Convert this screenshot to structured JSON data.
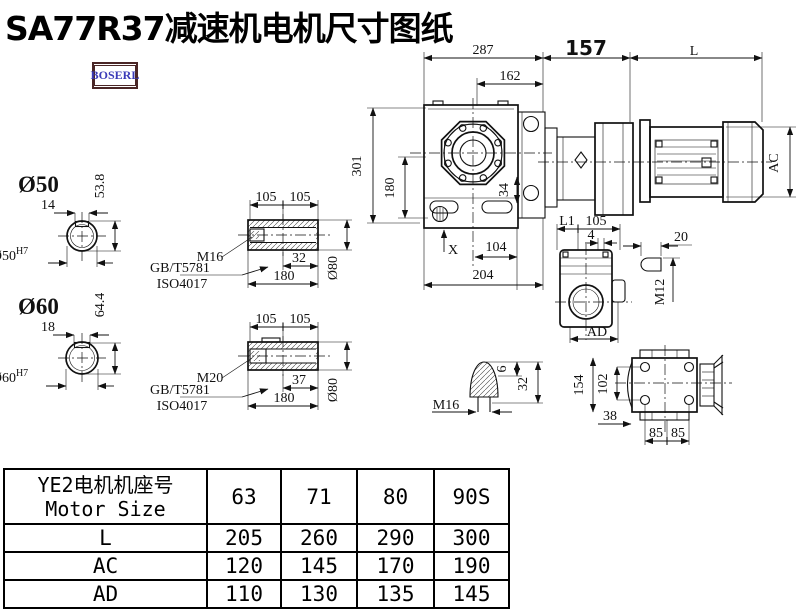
{
  "title": "SA77R37减速机电机尺寸图纸",
  "logo": {
    "text": "BOSERL"
  },
  "colors": {
    "line": "#111111",
    "logo_border": "#4a2626",
    "logo_text": "#3b3bb8",
    "background": "#ffffff"
  },
  "drawing": {
    "top": {
      "d287": "287",
      "d162": "162",
      "d157": "157",
      "dL": "L"
    },
    "front": {
      "d301": "301",
      "d180": "180",
      "d34": "34",
      "dX": "X",
      "d104": "104",
      "d204": "204"
    },
    "motor": {
      "dAC": "AC"
    },
    "side": {
      "dL1": "L1",
      "d105": "105",
      "d4": "4",
      "dAD": "AD"
    },
    "plug": {
      "d20": "20",
      "m12": "M12"
    },
    "topview": {
      "d154": "154",
      "d102": "102",
      "d38": "38",
      "d85a": "85",
      "d85b": "85"
    },
    "shaft50": {
      "label": "Ø50",
      "d14": "14",
      "d538": "53.8",
      "bore": "Ø50",
      "fit": "H7"
    },
    "shaft60": {
      "label": "Ø60",
      "d18": "18",
      "d644": "64.4",
      "bore": "Ø60",
      "fit": "H7"
    },
    "sleeve1": {
      "d105a": "105",
      "d105b": "105",
      "d32": "32",
      "d180": "180",
      "dia": "Ø80",
      "thread": "M16",
      "std1": "GB/T5781",
      "std2": "ISO4017"
    },
    "sleeve2": {
      "d105a": "105",
      "d105b": "105",
      "d37": "37",
      "d180": "180",
      "dia": "Ø80",
      "thread": "M20",
      "std1": "GB/T5781",
      "std2": "ISO4017"
    },
    "cone": {
      "d6": "6",
      "d32": "32",
      "thread": "M16"
    }
  },
  "table": {
    "header_cn": "YE2电机机座号",
    "header_en": "Motor Size",
    "columns": [
      "63",
      "71",
      "80",
      "90S"
    ],
    "rows": [
      {
        "label": "L",
        "values": [
          "205",
          "260",
          "290",
          "300"
        ]
      },
      {
        "label": "AC",
        "values": [
          "120",
          "145",
          "170",
          "190"
        ]
      },
      {
        "label": "AD",
        "values": [
          "110",
          "130",
          "135",
          "145"
        ]
      }
    ]
  }
}
